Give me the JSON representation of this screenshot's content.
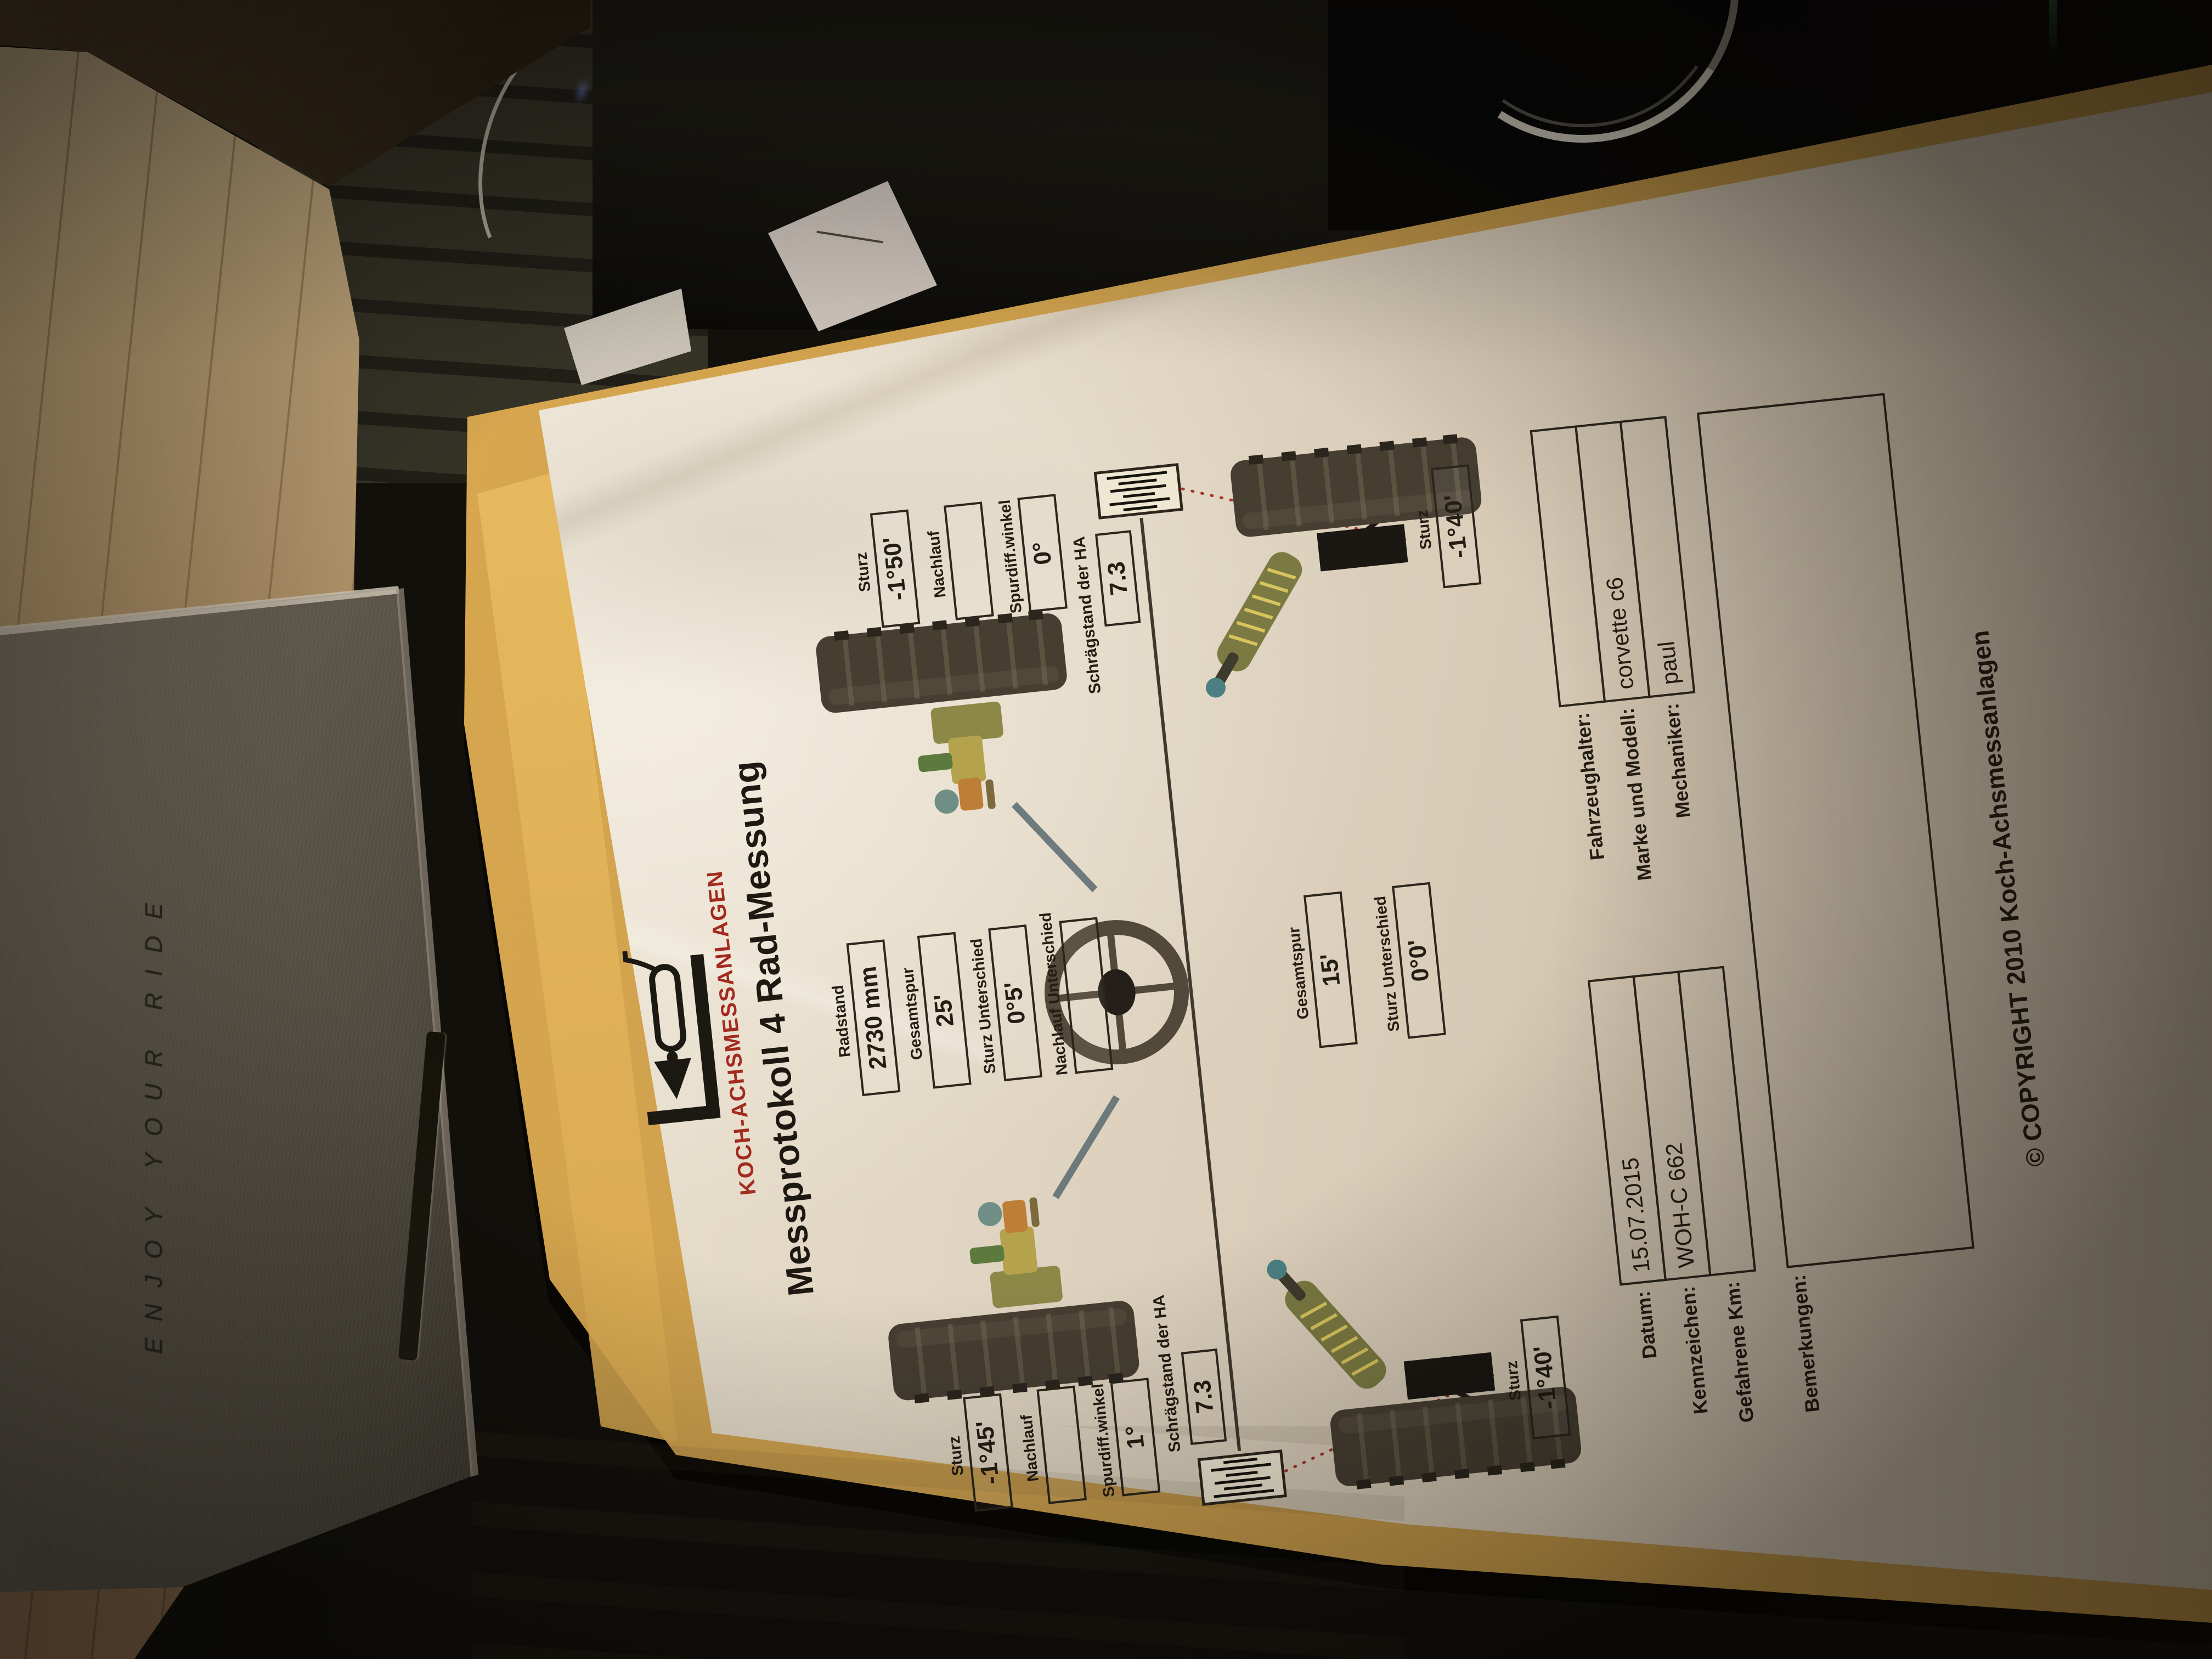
{
  "scene": {
    "box_text": "ENJOY YOUR RIDE"
  },
  "document": {
    "brand": "KOCH-ACHSMESSANLAGEN",
    "title": "Messprotokoll 4 Rad-Messung",
    "front": {
      "center": [
        {
          "label": "Radstand",
          "value": "2730 mm"
        },
        {
          "label": "Gesamtspur",
          "value": "25'"
        },
        {
          "label": "Sturz Unterschied",
          "value": "0°5'"
        },
        {
          "label": "Nachlauf Unterschied",
          "value": ""
        }
      ],
      "left": [
        {
          "label": "Sturz",
          "value": "-1°45'"
        },
        {
          "label": "Nachlauf",
          "value": ""
        },
        {
          "label": "Spurdiff.winkel",
          "value": "1°"
        }
      ],
      "right": [
        {
          "label": "Sturz",
          "value": "-1°50'"
        },
        {
          "label": "Nachlauf",
          "value": ""
        },
        {
          "label": "Spurdiff.winkel",
          "value": "0°"
        }
      ]
    },
    "ha": {
      "label_left": "Schrägstand der HA",
      "label_right": "Schrägstand der HA",
      "left_value": "7.3",
      "right_value": "7.3"
    },
    "rear": {
      "center": [
        {
          "label": "Gesamtspur",
          "value": "15'"
        },
        {
          "label": "Sturz Unterschied",
          "value": "0°0'"
        }
      ],
      "left_sturz": {
        "label": "Sturz",
        "value": "-1°40'"
      },
      "right_sturz": {
        "label": "Sturz",
        "value": "-1°40'"
      }
    },
    "form": {
      "left": [
        {
          "label": "Datum:",
          "value": "15.07.2015"
        },
        {
          "label": "Kennzeichen:",
          "value": "WOH-C 662"
        },
        {
          "label": "Gefahrene Km:",
          "value": ""
        }
      ],
      "right": [
        {
          "label": "Fahrzeughalter:",
          "value": ""
        },
        {
          "label": "Marke und Modell:",
          "value": "corvette c6"
        },
        {
          "label": "Mechaniker:",
          "value": "paul"
        }
      ],
      "remarks_label": "Bemerkungen:"
    },
    "copyright": "© COPYRIGHT 2010 Koch-Achsmessanlagen"
  }
}
